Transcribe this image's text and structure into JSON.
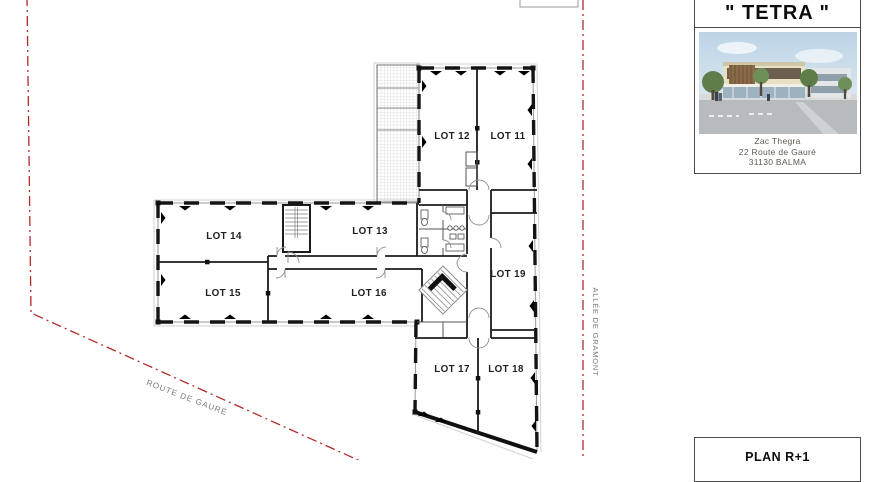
{
  "colors": {
    "boundary_red": "#b12b2b",
    "label_text": "#1f1f1f",
    "street_text": "#787878"
  },
  "title_block": {
    "title": "\" TETRA \"",
    "address": [
      "Zac Thegra",
      "22 Route de Gauré",
      "31130 BALMA"
    ]
  },
  "plan_block": {
    "label": "PLAN R+1"
  },
  "streets": {
    "route_de_gaure": "ROUTE DE GAURÉ",
    "allee_de_gramont": "ALLÉE DE GRAMONT"
  },
  "lots": [
    {
      "label": "LOT 11"
    },
    {
      "label": "LOT 12"
    },
    {
      "label": "LOT 13"
    },
    {
      "label": "LOT 14"
    },
    {
      "label": "LOT 15"
    },
    {
      "label": "LOT 16"
    },
    {
      "label": "LOT 17"
    },
    {
      "label": "LOT 18"
    },
    {
      "label": "LOT 19"
    }
  ]
}
